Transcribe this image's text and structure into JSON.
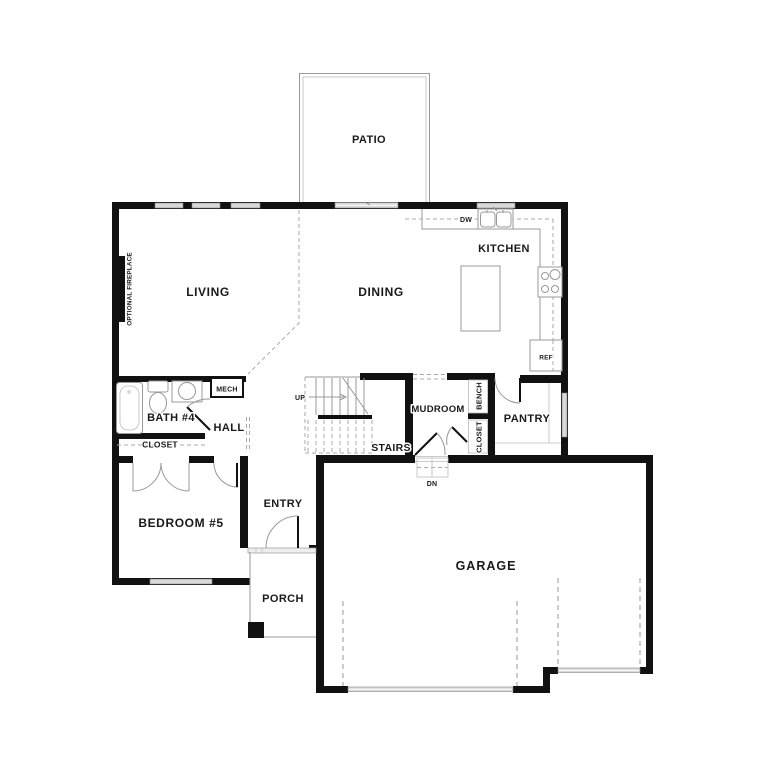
{
  "rooms": {
    "patio": "PATIO",
    "living": "LIVING",
    "dining": "DINING",
    "kitchen": "KITCHEN",
    "bath": "BATH #4",
    "hall": "HALL",
    "mech": "MECH",
    "closet_bath": "CLOSET",
    "bedroom": "BEDROOM #5",
    "entry": "ENTRY",
    "porch": "PORCH",
    "stairs": "STAIRS",
    "mudroom": "MUDROOM",
    "bench": "BENCH",
    "closet_mudroom": "CLOSET",
    "pantry": "PANTRY",
    "garage": "GARAGE"
  },
  "annotations": {
    "fireplace": "OPTIONAL FIREPLACE",
    "dishwasher": "DW",
    "refrigerator": "REF",
    "up": "UP",
    "down": "DN"
  },
  "colors": {
    "wall": "#111111",
    "thin_line": "#999999",
    "dashed_line": "#aaaaaa",
    "window_fill": "#d9d9d9",
    "background": "#ffffff",
    "text": "#1a1a1a"
  }
}
